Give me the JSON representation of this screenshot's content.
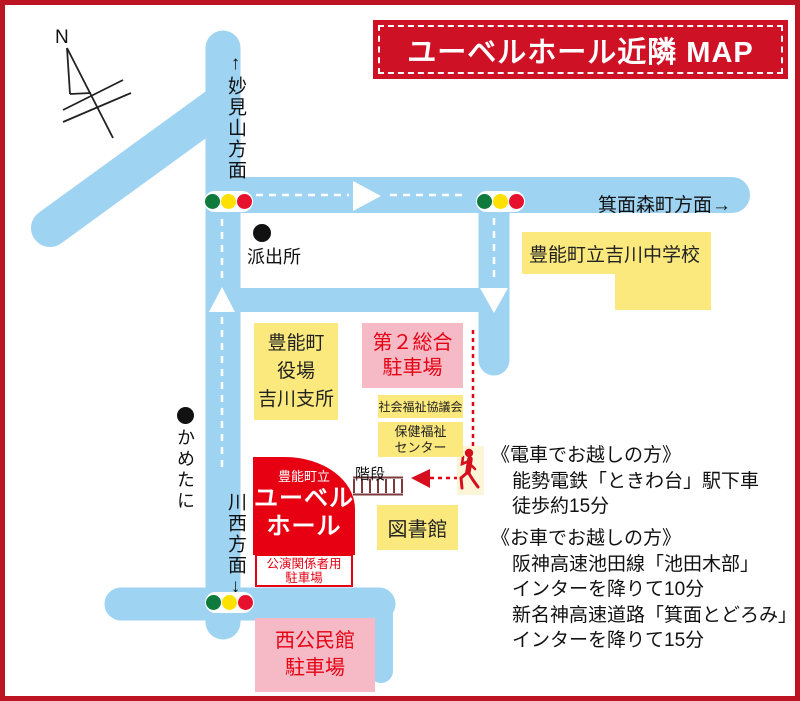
{
  "title": "ユーベルホール近隣 MAP",
  "compass_label": "N",
  "road_labels": {
    "north": "↑妙見山方面",
    "east": "箕面森町方面→",
    "south": "川西方面↓"
  },
  "landmarks": {
    "police_box": "派出所",
    "kametani": "かめたに",
    "school": "豊能町立吉川中学校",
    "town_office": [
      "豊能町",
      "役場",
      "吉川支所"
    ],
    "general_parking": [
      "第２総合",
      "駐車場"
    ],
    "welfare_council": "社会福祉協議会",
    "health_center": [
      "保健福祉",
      "センター"
    ],
    "stairs": "階段",
    "library": "図書館",
    "hall": [
      "豊能町立",
      "ユーベル",
      "ホール"
    ],
    "performers_parking": [
      "公演関係者用",
      "駐車場"
    ],
    "community_parking": [
      "西公民館",
      "駐車場"
    ]
  },
  "access": {
    "train": {
      "heading": "《電車でお越しの方》",
      "lines": [
        "能勢電鉄「ときわ台」駅下車",
        "徒歩約15分"
      ]
    },
    "car": {
      "heading": "《お車でお越しの方》",
      "lines": [
        "阪神高速池田線「池田木部」",
        "インターを降りて10分",
        "新名神高速道路「箕面とどろみ」",
        "インターを降りて15分"
      ]
    }
  },
  "colors": {
    "frame_red": "#bc1422",
    "title_red": "#cf1126",
    "road_blue": "#9ed3f2",
    "box_yellow": "#fbe97e",
    "box_pink": "#f5bac5",
    "accent_red": "#e50012",
    "hall_red": "#e60012",
    "signal_green": "#0e7a3c",
    "signal_yellow": "#ffe100",
    "signal_red": "#e8112d",
    "stairs_brown": "#7d3b40"
  }
}
